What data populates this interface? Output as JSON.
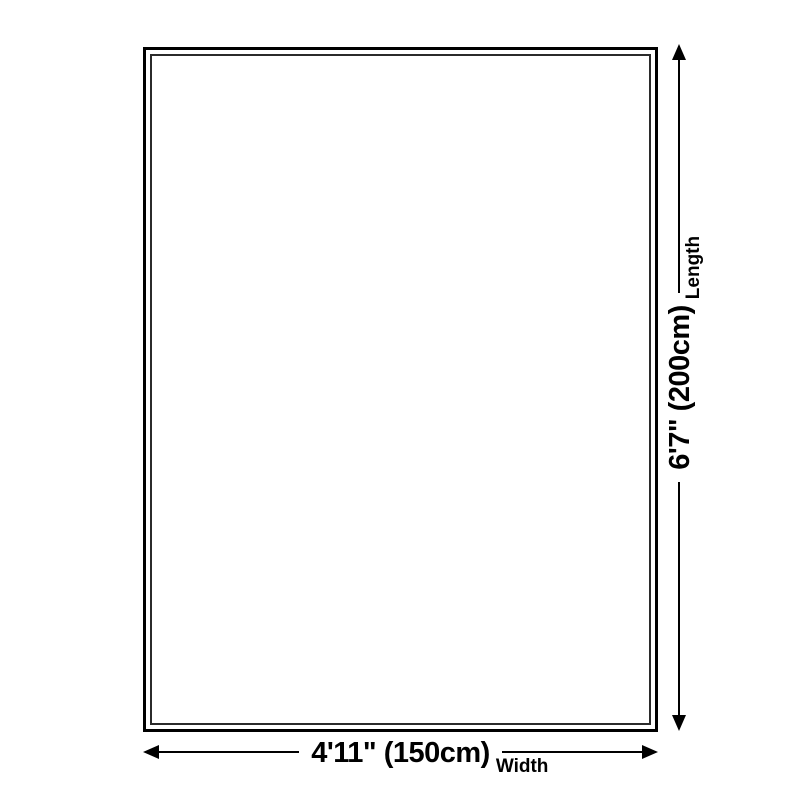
{
  "diagram": {
    "colors": {
      "background": "#ffffff",
      "outline": "#000000",
      "outline-inner": "#2b2b2b",
      "arrow": "#000000",
      "text": "#000000"
    },
    "width_dimension": {
      "value": "4'11\" (150cm)",
      "axis_label": "Width"
    },
    "length_dimension": {
      "value": "6'7\" (200cm)",
      "axis_label": "Length"
    }
  }
}
